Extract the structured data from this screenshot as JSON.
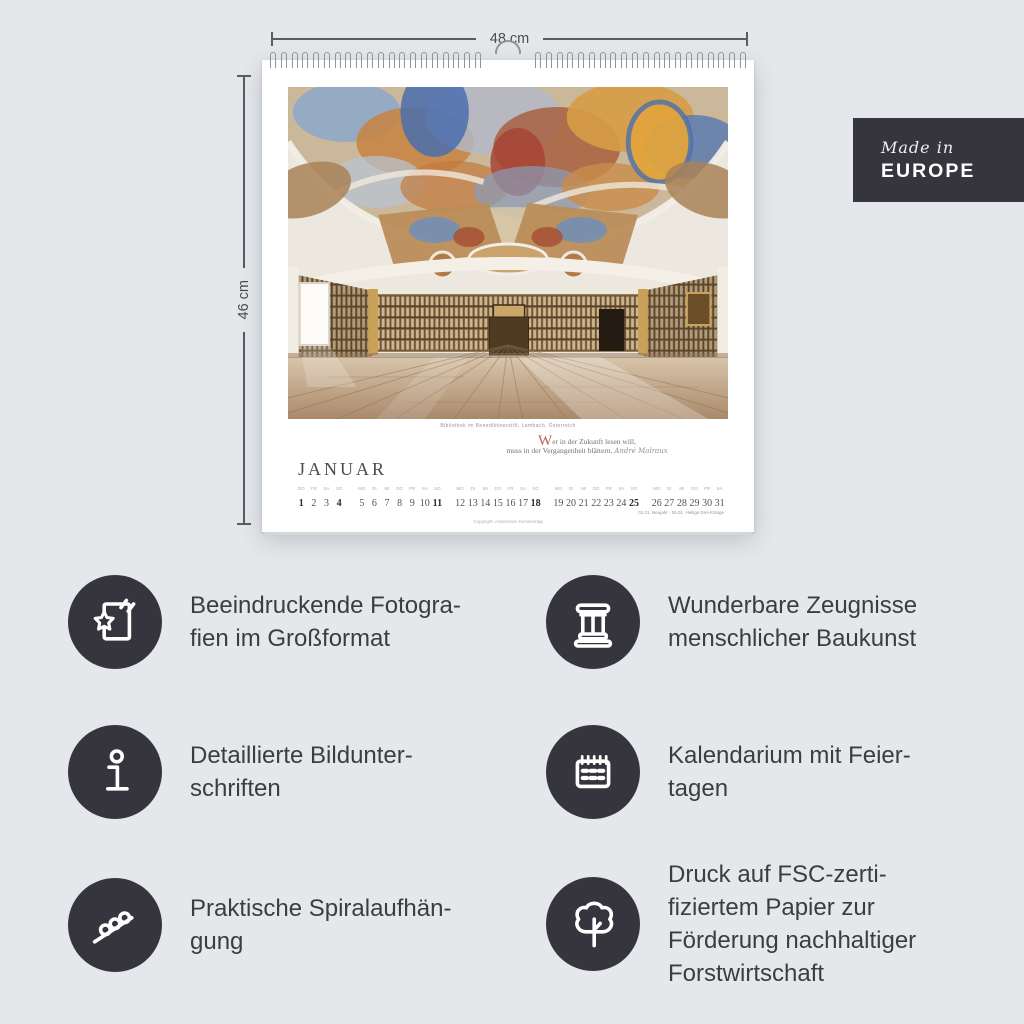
{
  "colors": {
    "background": "#e5e8eb",
    "accent_dark": "#36353d",
    "text": "#3d3c43",
    "dropcap_red": "#b4625a",
    "paper": "#ffffff"
  },
  "dimensions": {
    "width": "48 cm",
    "height": "46 cm"
  },
  "badge": {
    "script": "Made in",
    "name": "EUROPE"
  },
  "calendar": {
    "month": "JANUAR",
    "photo_caption": "Bibliothek im Benediktinerstift, Lambach, Österreich",
    "quote": {
      "dropcap": "W",
      "rest": "er in der Zukunft lesen will,",
      "line2": "muss in der Vergangenheit blättern.",
      "attribution": "André Malraux"
    },
    "holiday_note": "01.01. Neujahr · 06.01. Heilige Drei Könige",
    "copyright": "Copyright: Ackermann Kunstverlag",
    "weeks": [
      {
        "days": [
          {
            "wd": "Do",
            "date": "1",
            "bold": true
          },
          {
            "wd": "Fr",
            "date": "2"
          },
          {
            "wd": "Sa",
            "date": "3"
          },
          {
            "wd": "So",
            "date": "4",
            "bold": true
          }
        ]
      },
      {
        "days": [
          {
            "wd": "Mo",
            "date": "5"
          },
          {
            "wd": "Di",
            "date": "6"
          },
          {
            "wd": "Mi",
            "date": "7"
          },
          {
            "wd": "Do",
            "date": "8"
          },
          {
            "wd": "Fr",
            "date": "9"
          },
          {
            "wd": "Sa",
            "date": "10"
          },
          {
            "wd": "So",
            "date": "11",
            "bold": true
          }
        ]
      },
      {
        "days": [
          {
            "wd": "Mo",
            "date": "12"
          },
          {
            "wd": "Di",
            "date": "13"
          },
          {
            "wd": "Mi",
            "date": "14"
          },
          {
            "wd": "Do",
            "date": "15"
          },
          {
            "wd": "Fr",
            "date": "16"
          },
          {
            "wd": "Sa",
            "date": "17"
          },
          {
            "wd": "So",
            "date": "18",
            "bold": true
          }
        ]
      },
      {
        "days": [
          {
            "wd": "Mo",
            "date": "19"
          },
          {
            "wd": "Di",
            "date": "20"
          },
          {
            "wd": "Mi",
            "date": "21"
          },
          {
            "wd": "Do",
            "date": "22"
          },
          {
            "wd": "Fr",
            "date": "23"
          },
          {
            "wd": "Sa",
            "date": "24"
          },
          {
            "wd": "So",
            "date": "25",
            "bold": true
          }
        ]
      },
      {
        "days": [
          {
            "wd": "Mo",
            "date": "26"
          },
          {
            "wd": "Di",
            "date": "27"
          },
          {
            "wd": "Mi",
            "date": "28"
          },
          {
            "wd": "Do",
            "date": "29"
          },
          {
            "wd": "Fr",
            "date": "30"
          },
          {
            "wd": "Sa",
            "date": "31"
          }
        ]
      }
    ]
  },
  "features": [
    {
      "icon": "photo-star-icon",
      "text": "Beeindruckende Fotogra-\nfien im Großformat"
    },
    {
      "icon": "column-icon",
      "text": "Wunderbare Zeugnisse\nmenschlicher Baukunst"
    },
    {
      "icon": "info-icon",
      "text": "Detaillierte Bildunter-\nschriften"
    },
    {
      "icon": "calendar-icon",
      "text": "Kalendarium mit Feier-\ntagen"
    },
    {
      "icon": "spiral-icon",
      "text": "Praktische Spiralaufhän-\ngung"
    },
    {
      "icon": "tree-icon",
      "text": "Druck auf FSC-zerti-\nfiziertem Papier zur\nFörderung nachhaltiger\nForstwirtschaft"
    }
  ]
}
